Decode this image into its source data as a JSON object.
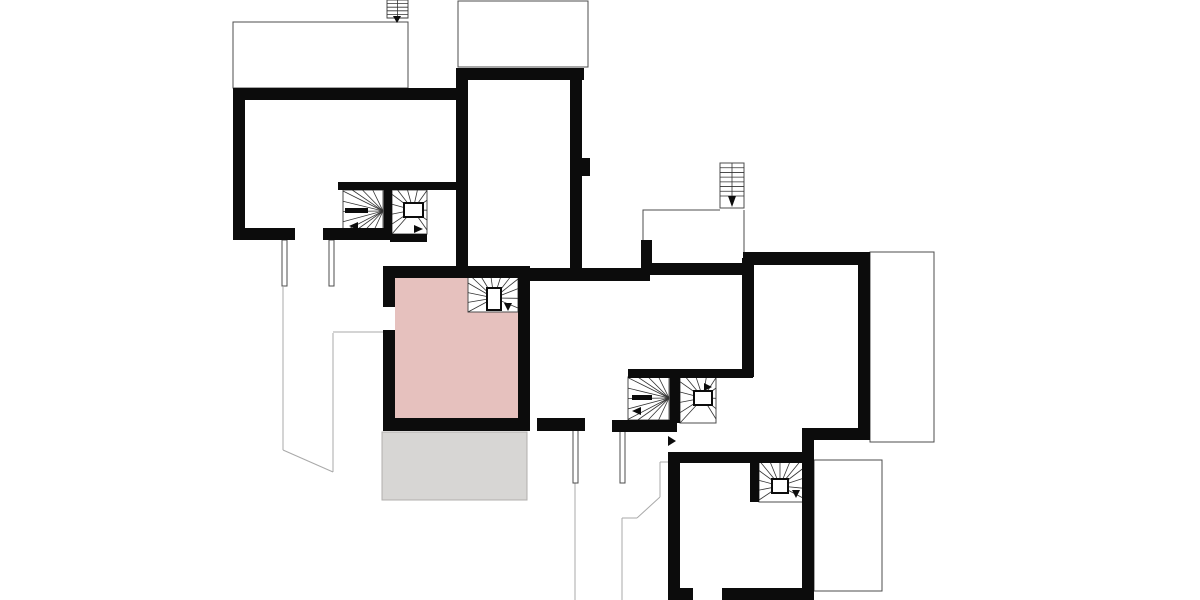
{
  "canvas": {
    "w": 1200,
    "h": 600,
    "bg": "#ffffff"
  },
  "palette": {
    "wall": "#0c0c0c",
    "edge": "#4d4d4d",
    "site": "#a9a9a9",
    "tread": "#333333",
    "pink": "#e6c1be",
    "gray": "#d7d6d4",
    "gray_edge": "#b0afad",
    "white": "#ffffff"
  },
  "rooms": [
    {
      "name": "highlighted-room",
      "x": 395,
      "y": 278,
      "w": 123,
      "h": 140,
      "fill": "pink",
      "stroke": ""
    },
    {
      "name": "terrace",
      "x": 382,
      "y": 432,
      "w": 145,
      "h": 68,
      "fill": "gray",
      "stroke": "gray_edge"
    }
  ],
  "outlines": [
    {
      "name": "roof-outline-top-left",
      "kind": "rect",
      "x": 233,
      "y": 22,
      "w": 175,
      "h": 66
    },
    {
      "name": "roof-outline-top-middle",
      "kind": "rect",
      "x": 458,
      "y": 1,
      "w": 130,
      "h": 66
    },
    {
      "name": "roof-outline-right",
      "kind": "rect",
      "x": 870,
      "y": 252,
      "w": 64,
      "h": 190
    },
    {
      "name": "roof-outline-bottom-right",
      "kind": "rect",
      "x": 814,
      "y": 460,
      "w": 68,
      "h": 131
    },
    {
      "name": "level-outline-left",
      "kind": "polyline",
      "pts": [
        [
          643,
          240
        ],
        [
          643,
          210
        ],
        [
          720,
          210
        ]
      ]
    },
    {
      "name": "level-outline-right-edge",
      "kind": "line",
      "x1": 744,
      "y1": 210,
      "x2": 744,
      "y2": 263
    }
  ],
  "site_lines": [
    {
      "x1": 283,
      "y1": 287,
      "x2": 283,
      "y2": 450
    },
    {
      "x1": 283,
      "y1": 450,
      "x2": 333,
      "y2": 472
    },
    {
      "x1": 333,
      "y1": 333,
      "x2": 333,
      "y2": 472
    },
    {
      "x1": 333,
      "y1": 332,
      "x2": 383,
      "y2": 332
    },
    {
      "x1": 575,
      "y1": 483,
      "x2": 575,
      "y2": 600
    },
    {
      "x1": 622,
      "y1": 518,
      "x2": 622,
      "y2": 600
    },
    {
      "x1": 622,
      "y1": 518,
      "x2": 637,
      "y2": 518
    },
    {
      "x1": 637,
      "y1": 518,
      "x2": 660,
      "y2": 497
    },
    {
      "x1": 660,
      "y1": 462,
      "x2": 660,
      "y2": 497
    },
    {
      "x1": 660,
      "y1": 462,
      "x2": 668,
      "y2": 462
    }
  ],
  "posts": [
    {
      "name": "post",
      "x": 282,
      "y": 240,
      "w": 5,
      "h": 46
    },
    {
      "name": "post",
      "x": 329,
      "y": 240,
      "w": 5,
      "h": 46
    },
    {
      "name": "post",
      "x": 573,
      "y": 430,
      "w": 5,
      "h": 53
    },
    {
      "name": "post",
      "x": 620,
      "y": 430,
      "w": 5,
      "h": 53
    }
  ],
  "stairs": [
    {
      "name": "winder-stair-upper-left-a",
      "kind": "winder",
      "box": {
        "x": 343,
        "y": 190,
        "w": 41,
        "h": 43
      },
      "hub": [
        383,
        211
      ],
      "fan": [
        [
          383,
          190
        ],
        [
          343,
          190
        ],
        [
          343,
          233
        ],
        [
          383,
          233
        ]
      ],
      "count": 13,
      "rail": {
        "x": 345,
        "y": 208,
        "w": 23,
        "h": 5
      },
      "arrow": [
        [
          358,
          222
        ],
        [
          358,
          230
        ],
        [
          349,
          226
        ]
      ]
    },
    {
      "name": "winder-stair-upper-left-b",
      "kind": "winder",
      "box": {
        "x": 392,
        "y": 190,
        "w": 35,
        "h": 44
      },
      "hub": [
        413,
        210
      ],
      "fan": [
        [
          392,
          234
        ],
        [
          392,
          190
        ],
        [
          427,
          190
        ],
        [
          427,
          230
        ]
      ],
      "count": 13,
      "newel": {
        "x": 404,
        "y": 203,
        "w": 19,
        "h": 14
      },
      "arrow": [
        [
          414,
          225
        ],
        [
          414,
          233
        ],
        [
          423,
          229
        ]
      ]
    },
    {
      "name": "winder-stair-highlighted-room",
      "kind": "winder",
      "box": {
        "x": 468,
        "y": 277,
        "w": 50,
        "h": 35
      },
      "hub": [
        494,
        298
      ],
      "fan": [
        [
          468,
          312
        ],
        [
          468,
          277
        ],
        [
          518,
          277
        ],
        [
          518,
          308
        ]
      ],
      "count": 13,
      "newel": {
        "x": 487,
        "y": 288,
        "w": 14,
        "h": 22
      },
      "arrow": [
        [
          504,
          303
        ],
        [
          512,
          303
        ],
        [
          508,
          311
        ]
      ]
    },
    {
      "name": "winder-stair-center-a",
      "kind": "winder",
      "box": {
        "x": 628,
        "y": 377,
        "w": 42,
        "h": 43
      },
      "hub": [
        669,
        398
      ],
      "fan": [
        [
          669,
          377
        ],
        [
          628,
          377
        ],
        [
          628,
          420
        ],
        [
          669,
          420
        ]
      ],
      "count": 13,
      "rail": {
        "x": 632,
        "y": 395,
        "w": 20,
        "h": 5
      },
      "arrow": [
        [
          641,
          407
        ],
        [
          641,
          415
        ],
        [
          632,
          411
        ]
      ]
    },
    {
      "name": "winder-stair-center-b",
      "kind": "winder",
      "box": {
        "x": 680,
        "y": 377,
        "w": 36,
        "h": 46
      },
      "hub": [
        703,
        398
      ],
      "fan": [
        [
          680,
          423
        ],
        [
          680,
          377
        ],
        [
          716,
          377
        ],
        [
          716,
          419
        ]
      ],
      "count": 13,
      "newel": {
        "x": 694,
        "y": 391,
        "w": 18,
        "h": 14
      },
      "arrow": [
        [
          704,
          383
        ],
        [
          704,
          391
        ],
        [
          712,
          387
        ]
      ]
    },
    {
      "name": "winder-stair-lower-right",
      "kind": "winder",
      "box": {
        "x": 759,
        "y": 462,
        "w": 44,
        "h": 40
      },
      "hub": [
        780,
        486
      ],
      "fan": [
        [
          759,
          500
        ],
        [
          759,
          462
        ],
        [
          803,
          462
        ],
        [
          803,
          498
        ]
      ],
      "count": 13,
      "newel": {
        "x": 772,
        "y": 479,
        "w": 16,
        "h": 14
      },
      "arrow": [
        [
          792,
          490
        ],
        [
          800,
          490
        ],
        [
          796,
          498
        ]
      ]
    },
    {
      "name": "straight-stair-top-left",
      "kind": "straight",
      "box": {
        "x": 387,
        "y": 0,
        "w": 21,
        "h": 18
      },
      "count": 6,
      "tb": 18,
      "arrow": [
        [
          393,
          16
        ],
        [
          401,
          16
        ],
        [
          397,
          23
        ]
      ]
    },
    {
      "name": "straight-stair-top-right",
      "kind": "straight",
      "box": {
        "x": 720,
        "y": 163,
        "w": 24,
        "h": 45
      },
      "count": 8,
      "tb": 196,
      "arrow": [
        [
          728,
          196
        ],
        [
          736,
          196
        ],
        [
          732,
          207
        ]
      ]
    }
  ],
  "walls": [
    {
      "name": "wall-upper-left-north",
      "x": 233,
      "y": 88,
      "w": 233,
      "h": 12
    },
    {
      "name": "wall-upper-left-west",
      "x": 233,
      "y": 88,
      "w": 12,
      "h": 152
    },
    {
      "name": "wall-upper-left-south-a",
      "x": 233,
      "y": 228,
      "w": 62,
      "h": 12
    },
    {
      "name": "wall-upper-left-south-b",
      "x": 323,
      "y": 228,
      "w": 67,
      "h": 12
    },
    {
      "name": "wall-stair1-south",
      "x": 390,
      "y": 234,
      "w": 37,
      "h": 8
    },
    {
      "name": "wall-stair1-north",
      "x": 338,
      "y": 182,
      "w": 130,
      "h": 8
    },
    {
      "name": "wall-stair1-divider",
      "x": 384,
      "y": 190,
      "w": 8,
      "h": 48
    },
    {
      "name": "wall-central-west",
      "x": 456,
      "y": 68,
      "w": 12,
      "h": 210
    },
    {
      "name": "wall-central-north",
      "x": 456,
      "y": 68,
      "w": 128,
      "h": 12
    },
    {
      "name": "wall-central-east",
      "x": 570,
      "y": 80,
      "w": 12,
      "h": 190
    },
    {
      "name": "wall-central-east-bump",
      "x": 582,
      "y": 158,
      "w": 8,
      "h": 18
    },
    {
      "name": "wall-mid-north-a",
      "x": 530,
      "y": 268,
      "w": 120,
      "h": 13
    },
    {
      "name": "wall-mid-stub",
      "x": 641,
      "y": 240,
      "w": 11,
      "h": 30
    },
    {
      "name": "wall-mid-north-b",
      "x": 650,
      "y": 263,
      "w": 100,
      "h": 12
    },
    {
      "name": "wall-pink-north",
      "x": 383,
      "y": 266,
      "w": 147,
      "h": 12
    },
    {
      "name": "wall-pink-west-upper",
      "x": 383,
      "y": 266,
      "w": 12,
      "h": 41
    },
    {
      "name": "wall-pink-west-lower",
      "x": 383,
      "y": 330,
      "w": 12,
      "h": 100
    },
    {
      "name": "wall-pink-south",
      "x": 383,
      "y": 418,
      "w": 147,
      "h": 13
    },
    {
      "name": "wall-pink-east",
      "x": 518,
      "y": 278,
      "w": 12,
      "h": 152
    },
    {
      "name": "wall-south-door",
      "x": 537,
      "y": 418,
      "w": 48,
      "h": 13
    },
    {
      "name": "wall-stair2-south",
      "x": 612,
      "y": 420,
      "w": 65,
      "h": 12
    },
    {
      "name": "wall-stair2-north",
      "x": 628,
      "y": 369,
      "w": 125,
      "h": 9
    },
    {
      "name": "wall-stair2-divider",
      "x": 670,
      "y": 377,
      "w": 10,
      "h": 46
    },
    {
      "name": "wall-right-north",
      "x": 743,
      "y": 252,
      "w": 124,
      "h": 13
    },
    {
      "name": "wall-right-west",
      "x": 742,
      "y": 258,
      "w": 12,
      "h": 119
    },
    {
      "name": "wall-right-east",
      "x": 858,
      "y": 252,
      "w": 12,
      "h": 188
    },
    {
      "name": "wall-right-south",
      "x": 806,
      "y": 428,
      "w": 64,
      "h": 12
    },
    {
      "name": "wall-lowerright-east",
      "x": 802,
      "y": 428,
      "w": 12,
      "h": 172
    },
    {
      "name": "wall-lowerright-north",
      "x": 668,
      "y": 452,
      "w": 136,
      "h": 11
    },
    {
      "name": "wall-stair4-west",
      "x": 750,
      "y": 452,
      "w": 9,
      "h": 50
    },
    {
      "name": "wall-lowerright-west",
      "x": 668,
      "y": 452,
      "w": 12,
      "h": 148
    },
    {
      "name": "wall-lowerright-south-a",
      "x": 668,
      "y": 588,
      "w": 25,
      "h": 12
    },
    {
      "name": "wall-lowerright-south-b",
      "x": 722,
      "y": 588,
      "w": 92,
      "h": 12
    }
  ],
  "arrows": [
    {
      "name": "entry-arrow",
      "pts": [
        [
          668,
          436
        ],
        [
          668,
          446
        ],
        [
          676,
          441
        ]
      ]
    }
  ]
}
